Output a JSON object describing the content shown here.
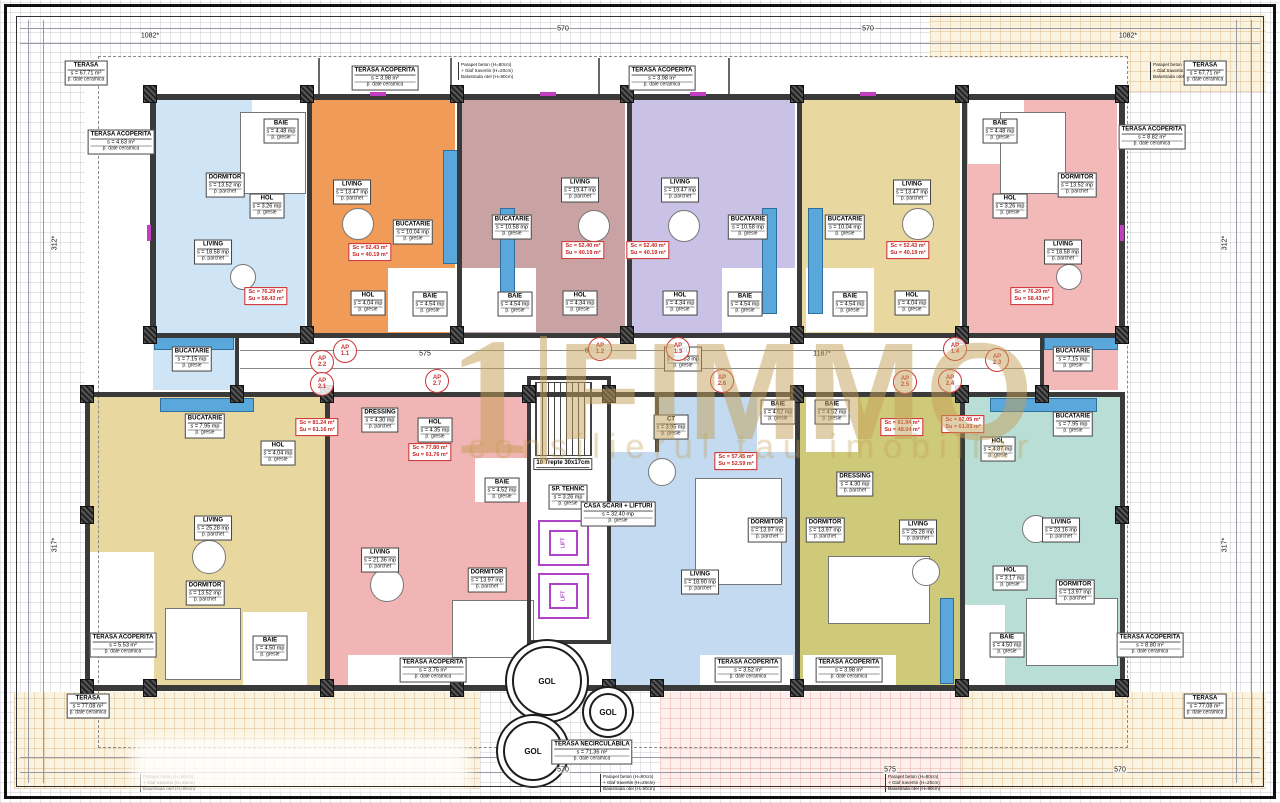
{
  "watermark": {
    "prefix": "1",
    "brand": "FIMMO",
    "tagline": "consilierul tau imobiliar"
  },
  "parapet_note": {
    "lines": [
      "Parapet beton (H=80cm)",
      "+ Glaf travertin (H=20cm)",
      "Balustrada otel (H=90cm)"
    ],
    "positions": [
      {
        "x": 458,
        "y": 62
      },
      {
        "x": 1150,
        "y": 62
      },
      {
        "x": 600,
        "y": 774
      },
      {
        "x": 885,
        "y": 774
      },
      {
        "x": 140,
        "y": 774
      }
    ]
  },
  "core": {
    "lift_label": "LIFT",
    "labels": [
      {
        "n": "HOL",
        "a": "s = 41.33 mp",
        "f": "p. gresie",
        "x": 683,
        "y": 359
      },
      {
        "n": "SP. TEHNIC",
        "a": "s = 3.26 mp",
        "f": "p. gresie",
        "x": 568,
        "y": 497
      },
      {
        "n": "CASA SCARII + LIFTURI",
        "a": "s = 32.40 mp",
        "f": "p. gresie",
        "x": 618,
        "y": 514
      },
      {
        "n": "10 Trepte 30x17cm",
        "x": 563,
        "y": 464
      }
    ]
  },
  "apartments": [
    {
      "id": "ap-1",
      "color": "#cfe4f4",
      "area_box": {
        "sc": "Sc = 76.29 m²",
        "su": "Su = 58.43 m²",
        "x": 266,
        "y": 296
      },
      "rooms": [
        {
          "n": "DORMITOR",
          "a": "s = 13.52 mp",
          "f": "p. parchet",
          "x": 225,
          "y": 185
        },
        {
          "n": "BAIE",
          "a": "s = 4.48 mp",
          "f": "p. gresie",
          "x": 281,
          "y": 131
        },
        {
          "n": "HOL",
          "a": "s = 3.26 mp",
          "f": "p. gresie",
          "x": 267,
          "y": 206
        },
        {
          "n": "LIVING",
          "a": "s = 18.58 mp",
          "f": "p. parchet",
          "x": 213,
          "y": 252
        },
        {
          "n": "BUCATARIE",
          "a": "s = 7.15 mp",
          "f": "p. gresie",
          "x": 192,
          "y": 359
        }
      ]
    },
    {
      "id": "ap-2",
      "color": "#f09b58",
      "area_box": {
        "sc": "Sc = 52.43 m²",
        "su": "Su = 40.19 m²",
        "x": 370,
        "y": 252
      },
      "rooms": [
        {
          "n": "LIVING",
          "a": "s = 13.47 mp",
          "f": "p. parchet",
          "x": 352,
          "y": 192
        },
        {
          "n": "BUCATARIE",
          "a": "s = 10.04 mp",
          "f": "p. gresie",
          "x": 413,
          "y": 232
        },
        {
          "n": "HOL",
          "a": "s = 4.04 mp",
          "f": "p. gresie",
          "x": 368,
          "y": 303
        },
        {
          "n": "BAIE",
          "a": "s = 4.54 mp",
          "f": "p. gresie",
          "x": 430,
          "y": 304
        }
      ]
    },
    {
      "id": "ap-3",
      "color": "#c9a3a3",
      "area_box": {
        "sc": "Sc = 52.40 m²",
        "su": "Su = 40.19 m²",
        "x": 583,
        "y": 250
      },
      "rooms": [
        {
          "n": "BUCATARIE",
          "a": "s = 10.58 mp",
          "f": "p. gresie",
          "x": 512,
          "y": 227
        },
        {
          "n": "LIVING",
          "a": "s = 19.47 mp",
          "f": "p. parchet",
          "x": 580,
          "y": 190
        },
        {
          "n": "BAIE",
          "a": "s = 4.54 mp",
          "f": "p. gresie",
          "x": 515,
          "y": 304
        },
        {
          "n": "HOL",
          "a": "s = 4.34 mp",
          "f": "p. gresie",
          "x": 580,
          "y": 303
        }
      ]
    },
    {
      "id": "ap-4",
      "color": "#c9c2e6",
      "area_box": {
        "sc": "Sc = 52.40 m²",
        "su": "Su = 40.19 m²",
        "x": 648,
        "y": 250
      },
      "rooms": [
        {
          "n": "LIVING",
          "a": "s = 19.47 mp",
          "f": "p. parchet",
          "x": 680,
          "y": 190
        },
        {
          "n": "BUCATARIE",
          "a": "s = 10.58 mp",
          "f": "p. gresie",
          "x": 748,
          "y": 227
        },
        {
          "n": "HOL",
          "a": "s = 4.34 mp",
          "f": "p. gresie",
          "x": 680,
          "y": 303
        },
        {
          "n": "BAIE",
          "a": "s = 4.54 mp",
          "f": "p. gresie",
          "x": 745,
          "y": 304
        }
      ]
    },
    {
      "id": "ap-5",
      "color": "#e8d79f",
      "area_box": {
        "sc": "Sc = 52.43 m²",
        "su": "Su = 40.19 m²",
        "x": 908,
        "y": 250
      },
      "rooms": [
        {
          "n": "BUCATARIE",
          "a": "s = 10.04 mp",
          "f": "p. gresie",
          "x": 845,
          "y": 227
        },
        {
          "n": "LIVING",
          "a": "s = 13.47 mp",
          "f": "p. parchet",
          "x": 912,
          "y": 192
        },
        {
          "n": "BAIE",
          "a": "s = 4.54 mp",
          "f": "p. gresie",
          "x": 850,
          "y": 304
        },
        {
          "n": "HOL",
          "a": "s = 4.04 mp",
          "f": "p. gresie",
          "x": 912,
          "y": 303
        }
      ]
    },
    {
      "id": "ap-6",
      "color": "#f3b9b9",
      "area_box": {
        "sc": "Sc = 76.29 m²",
        "su": "Su = 58.43 m²",
        "x": 1032,
        "y": 296
      },
      "rooms": [
        {
          "n": "BAIE",
          "a": "s = 4.48 mp",
          "f": "p. gresie",
          "x": 1000,
          "y": 131
        },
        {
          "n": "DORMITOR",
          "a": "s = 13.52 mp",
          "f": "p. parchet",
          "x": 1077,
          "y": 185
        },
        {
          "n": "HOL",
          "a": "s = 3.26 mp",
          "f": "p. gresie",
          "x": 1010,
          "y": 206
        },
        {
          "n": "LIVING",
          "a": "s = 18.58 mp",
          "f": "p. parchet",
          "x": 1063,
          "y": 252
        },
        {
          "n": "BUCATARIE",
          "a": "s = 7.15 mp",
          "f": "p. gresie",
          "x": 1073,
          "y": 359
        }
      ]
    },
    {
      "id": "ap-7",
      "color": "#e8d79f",
      "area_box": {
        "sc": "Sc = 81.24 m²",
        "su": "Su = 61.16 m²",
        "x": 317,
        "y": 427
      },
      "rooms": [
        {
          "n": "BUCATARIE",
          "a": "s = 7.95 mp",
          "f": "p. gresie",
          "x": 205,
          "y": 426
        },
        {
          "n": "HOL",
          "a": "s = 4.04 mp",
          "f": "p. gresie",
          "x": 278,
          "y": 453
        },
        {
          "n": "LIVING",
          "a": "s = 25.28 mp",
          "f": "p. parchet",
          "x": 213,
          "y": 528
        },
        {
          "n": "DORMITOR",
          "a": "s = 13.52 mp",
          "f": "p. parchet",
          "x": 205,
          "y": 593
        },
        {
          "n": "BAIE",
          "a": "s = 4.50 mp",
          "f": "p. gresie",
          "x": 270,
          "y": 648
        }
      ]
    },
    {
      "id": "ap-8",
      "color": "#f2b5b5",
      "area_box": {
        "sc": "Sc = 77.80 m²",
        "su": "Su = 61.76 m²",
        "x": 430,
        "y": 452
      },
      "rooms": [
        {
          "n": "DRESSING",
          "a": "s = 4.30 mp",
          "f": "p. parchet",
          "x": 380,
          "y": 420
        },
        {
          "n": "HOL",
          "a": "s = 4.35 mp",
          "f": "p. gresie",
          "x": 435,
          "y": 430
        },
        {
          "n": "BAIE",
          "a": "s = 4.52 mp",
          "f": "p. gresie",
          "x": 502,
          "y": 490
        },
        {
          "n": "LIVING",
          "a": "s = 21.36 mp",
          "f": "p. parchet",
          "x": 380,
          "y": 560
        },
        {
          "n": "DORMITOR",
          "a": "s = 13.97 mp",
          "f": "p. parchet",
          "x": 487,
          "y": 580
        }
      ]
    },
    {
      "id": "ap-9",
      "color": "#c3daf0",
      "area_box": {
        "sc": "Sc = 57.45 m²",
        "su": "Su = 52.59 m²",
        "x": 736,
        "y": 461
      },
      "rooms": [
        {
          "n": "CT",
          "a": "s = 3.95 mp",
          "f": "p. gresie",
          "x": 671,
          "y": 427
        },
        {
          "n": "BAIE",
          "a": "s = 4.52 mp",
          "f": "p. gresie",
          "x": 778,
          "y": 412
        },
        {
          "n": "DORMITOR",
          "a": "s = 13.97 mp",
          "f": "p. parchet",
          "x": 767,
          "y": 530
        },
        {
          "n": "LIVING",
          "a": "s = 18.90 mp",
          "f": "p. parchet",
          "x": 700,
          "y": 582
        }
      ]
    },
    {
      "id": "ap-10",
      "color": "#cfc97a",
      "area_box": {
        "sc": "Sc = 61.94 m²",
        "su": "Su = 48.04 m²",
        "x": 902,
        "y": 427
      },
      "rooms": [
        {
          "n": "BAIE",
          "a": "s = 4.52 mp",
          "f": "p. gresie",
          "x": 832,
          "y": 412
        },
        {
          "n": "DRESSING",
          "a": "s = 4.30 mp",
          "f": "p. parchet",
          "x": 855,
          "y": 484
        },
        {
          "n": "DORMITOR",
          "a": "s = 13.97 mp",
          "f": "p. parchet",
          "x": 825,
          "y": 530
        },
        {
          "n": "LIVING",
          "a": "s = 25.28 mp",
          "f": "p. parchet",
          "x": 918,
          "y": 532
        }
      ]
    },
    {
      "id": "ap-11",
      "color": "#b9ded5",
      "area_box": {
        "sc": "Sc = 82.05 m²",
        "su": "Su = 61.03 m²",
        "x": 963,
        "y": 424
      },
      "rooms": [
        {
          "n": "BUCATARIE",
          "a": "s = 7.95 mp",
          "f": "p. gresie",
          "x": 1073,
          "y": 424
        },
        {
          "n": "HOL",
          "a": "s = 4.87 mp",
          "f": "p. gresie",
          "x": 998,
          "y": 449
        },
        {
          "n": "LIVING",
          "a": "s = 23.16 mp",
          "f": "p. parchet",
          "x": 1061,
          "y": 530
        },
        {
          "n": "HOL",
          "a": "s = 3.17 mp",
          "f": "p. gresie",
          "x": 1010,
          "y": 578
        },
        {
          "n": "DORMITOR",
          "a": "s = 13.97 mp",
          "f": "p. parchet",
          "x": 1075,
          "y": 592
        },
        {
          "n": "BAIE",
          "a": "s = 4.50 mp",
          "f": "p. gresie",
          "x": 1007,
          "y": 645
        }
      ]
    }
  ],
  "terraces": [
    {
      "n": "TERASA",
      "a": "s = 67.71 m²",
      "f": "p. dale ceramica",
      "x": 86,
      "y": 73
    },
    {
      "n": "TERASA",
      "a": "s = 67.71 m²",
      "f": "p. dale ceramica",
      "x": 1205,
      "y": 73
    },
    {
      "n": "TERASA ACOPERITA",
      "a": "s = 4.63 m²",
      "f": "p. dale ceramica",
      "x": 121,
      "y": 142
    },
    {
      "n": "TERASA ACOPERITA",
      "a": "s = 3.98 m²",
      "f": "p. dale ceramica",
      "x": 385,
      "y": 78
    },
    {
      "n": "TERASA ACOPERITA",
      "a": "s = 3.98 m²",
      "f": "p. dale ceramica",
      "x": 662,
      "y": 78
    },
    {
      "n": "TERASA ACOPERITA",
      "a": "s = 8.82 m²",
      "f": "p. dale ceramica",
      "x": 1152,
      "y": 137
    },
    {
      "n": "TERASA ACOPERITA",
      "a": "s = 5.53 m²",
      "f": "p. dale ceramica",
      "x": 123,
      "y": 645
    },
    {
      "n": "TERASA ACOPERITA",
      "a": "s = 3.75 m²",
      "f": "p. dale ceramica",
      "x": 433,
      "y": 670
    },
    {
      "n": "TERASA ACOPERITA",
      "a": "s = 3.52 m²",
      "f": "p. dale ceramica",
      "x": 748,
      "y": 670
    },
    {
      "n": "TERASA ACOPERITA",
      "a": "s = 3.98 m²",
      "f": "p. dale ceramica",
      "x": 849,
      "y": 670
    },
    {
      "n": "TERASA ACOPERITA",
      "a": "s = 8.80 m²",
      "f": "p. dale ceramica",
      "x": 1150,
      "y": 645
    },
    {
      "n": "TERASA",
      "a": "s = 77.08 m²",
      "f": "p. dale ceramica",
      "x": 88,
      "y": 706
    },
    {
      "n": "TERASA",
      "a": "s = 77.08 m²",
      "f": "p. dale ceramica",
      "x": 1205,
      "y": 706
    },
    {
      "n": "TERASA NECIRCULABILA",
      "a": "s = 71.36 m²",
      "f": "p. dale ceramica",
      "x": 592,
      "y": 752
    }
  ],
  "ap_markers": [
    {
      "t": "AP",
      "num": "1.1",
      "x": 345,
      "y": 351
    },
    {
      "t": "AP",
      "num": "1.2",
      "x": 600,
      "y": 349
    },
    {
      "t": "AP",
      "num": "1.3",
      "x": 678,
      "y": 349
    },
    {
      "t": "AP",
      "num": "1.4",
      "x": 955,
      "y": 349
    },
    {
      "t": "AP",
      "num": "2.2",
      "x": 322,
      "y": 362
    },
    {
      "t": "AP",
      "num": "2.1",
      "x": 322,
      "y": 384
    },
    {
      "t": "AP",
      "num": "2.7",
      "x": 437,
      "y": 381
    },
    {
      "t": "AP",
      "num": "2.6",
      "x": 722,
      "y": 381
    },
    {
      "t": "AP",
      "num": "2.5",
      "x": 905,
      "y": 382
    },
    {
      "t": "AP",
      "num": "2.4",
      "x": 950,
      "y": 381
    },
    {
      "t": "AP",
      "num": "2.3",
      "x": 997,
      "y": 360
    }
  ],
  "gol": [
    {
      "t": "GOL",
      "x": 547,
      "y": 681,
      "r": 33
    },
    {
      "t": "GOL",
      "x": 608,
      "y": 712,
      "r": 17
    },
    {
      "t": "GOL",
      "x": 533,
      "y": 751,
      "r": 28
    }
  ],
  "dimensions": [
    {
      "t": "1082*",
      "x": 150,
      "y": 36
    },
    {
      "t": "570",
      "x": 563,
      "y": 29
    },
    {
      "t": "570",
      "x": 868,
      "y": 29
    },
    {
      "t": "1082*",
      "x": 1128,
      "y": 36
    },
    {
      "t": "575",
      "x": 425,
      "y": 354
    },
    {
      "t": "602*",
      "x": 592,
      "y": 351
    },
    {
      "t": "1187*",
      "x": 822,
      "y": 354
    },
    {
      "t": "570",
      "x": 563,
      "y": 770
    },
    {
      "t": "575",
      "x": 890,
      "y": 770
    },
    {
      "t": "570",
      "x": 1120,
      "y": 770
    },
    {
      "t": "312*",
      "x": 55,
      "y": 243,
      "rot": true
    },
    {
      "t": "317*",
      "x": 55,
      "y": 545,
      "rot": true
    },
    {
      "t": "312*",
      "x": 1225,
      "y": 243,
      "rot": true
    },
    {
      "t": "317*",
      "x": 1225,
      "y": 545,
      "rot": true
    }
  ]
}
